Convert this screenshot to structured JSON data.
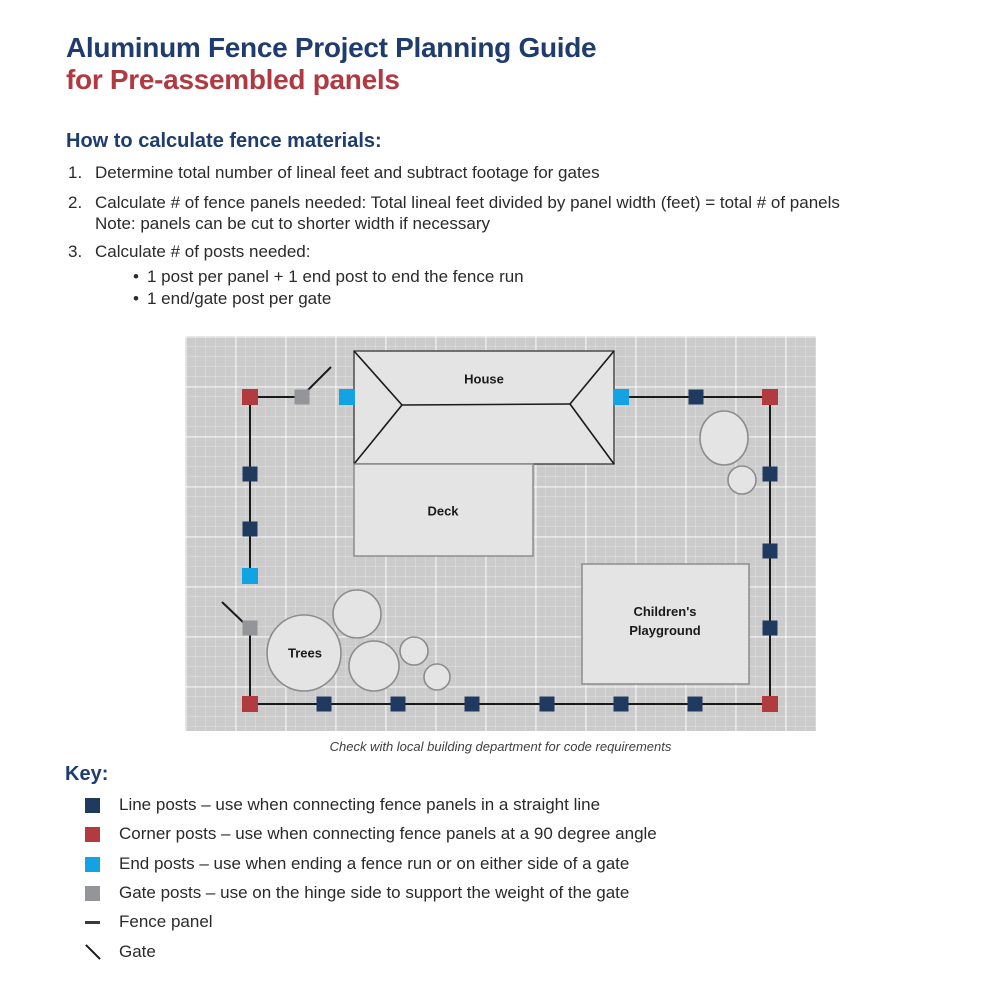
{
  "title": {
    "line1": "Aluminum Fence Project Planning Guide",
    "line2": "for Pre-assembled panels"
  },
  "colors": {
    "title_navy": "#1e3c6d",
    "title_red": "#b13a42",
    "text": "#2a2a2a",
    "line_post": "#20395f",
    "corner_post": "#b23b40",
    "end_post": "#14a3e2",
    "gate_post": "#939598",
    "fence_line": "#1a1a1a",
    "grid_bg": "#cbcbcb",
    "shape_fill": "#e4e4e4",
    "shape_stroke": "#8c8c8c",
    "house_stroke": "#4d4d4d"
  },
  "instructions": {
    "heading": "How to calculate fence materials:",
    "bullet_char": "•",
    "items": [
      {
        "num": "1.",
        "lines": [
          "Determine total number of lineal feet and subtract footage for gates"
        ]
      },
      {
        "num": "2.",
        "lines": [
          "Calculate # of fence panels needed: Total lineal feet divided by panel width (feet) = total # of panels",
          "Note: panels can be cut to shorter width if necessary"
        ]
      },
      {
        "num": "3.",
        "lines": [
          "Calculate # of posts needed:"
        ]
      }
    ],
    "bullets": [
      "1 post per panel + 1 end post to end the fence run",
      "1 end/gate post per gate"
    ]
  },
  "diagram": {
    "caption": "Check with local building department for code requirements",
    "labels": {
      "house": "House",
      "deck": "Deck",
      "trees": "Trees",
      "playground": "Children's\nPlayground"
    },
    "post_sizes": {
      "line": 15,
      "corner": 16,
      "end": 16,
      "gate": 15
    },
    "posts": [
      {
        "x": 65,
        "y": 61,
        "t": "corner"
      },
      {
        "x": 117,
        "y": 61,
        "t": "gate"
      },
      {
        "x": 162,
        "y": 61,
        "t": "end"
      },
      {
        "x": 436,
        "y": 61,
        "t": "end"
      },
      {
        "x": 511,
        "y": 61,
        "t": "line"
      },
      {
        "x": 585,
        "y": 61,
        "t": "corner"
      },
      {
        "x": 65,
        "y": 138,
        "t": "line"
      },
      {
        "x": 65,
        "y": 193,
        "t": "line"
      },
      {
        "x": 65,
        "y": 240,
        "t": "end"
      },
      {
        "x": 65,
        "y": 292,
        "t": "gate"
      },
      {
        "x": 585,
        "y": 138,
        "t": "line"
      },
      {
        "x": 585,
        "y": 215,
        "t": "line"
      },
      {
        "x": 585,
        "y": 292,
        "t": "line"
      },
      {
        "x": 65,
        "y": 368,
        "t": "corner"
      },
      {
        "x": 139,
        "y": 368,
        "t": "line"
      },
      {
        "x": 213,
        "y": 368,
        "t": "line"
      },
      {
        "x": 287,
        "y": 368,
        "t": "line"
      },
      {
        "x": 362,
        "y": 368,
        "t": "line"
      },
      {
        "x": 436,
        "y": 368,
        "t": "line"
      },
      {
        "x": 510,
        "y": 368,
        "t": "line"
      },
      {
        "x": 585,
        "y": 368,
        "t": "corner"
      }
    ],
    "fence_segments": [
      [
        65,
        61,
        117,
        61
      ],
      [
        436,
        61,
        585,
        61
      ],
      [
        585,
        61,
        585,
        368
      ],
      [
        65,
        368,
        585,
        368
      ],
      [
        65,
        61,
        65,
        243
      ],
      [
        65,
        292,
        65,
        368
      ]
    ],
    "gate_lines": [
      [
        123,
        54,
        146,
        31
      ],
      [
        37,
        266,
        60,
        288
      ]
    ],
    "house": {
      "x": 169,
      "y": 15,
      "w": 260,
      "h": 113,
      "roof_lines": [
        [
          169,
          15,
          217,
          69
        ],
        [
          169,
          128,
          217,
          69
        ],
        [
          217,
          69,
          385,
          68
        ],
        [
          429,
          15,
          385,
          68
        ],
        [
          429,
          128,
          385,
          68
        ]
      ]
    },
    "deck": {
      "x": 169,
      "y": 128,
      "w": 179,
      "h": 92
    },
    "playground": {
      "x": 397,
      "y": 228,
      "w": 167,
      "h": 120
    },
    "tree_circles": [
      [
        119,
        317,
        37,
        38
      ],
      [
        172,
        278,
        24,
        24
      ],
      [
        189,
        330,
        25,
        25
      ],
      [
        229,
        315,
        14,
        14
      ],
      [
        252,
        341,
        13,
        13
      ]
    ],
    "bush_circles": [
      [
        539,
        102,
        24,
        27
      ],
      [
        557,
        144,
        14,
        14
      ]
    ]
  },
  "key": {
    "heading": "Key:",
    "items": [
      {
        "symbol": "line_post",
        "label": "Line posts – use when connecting fence panels in a straight line"
      },
      {
        "symbol": "corner_post",
        "label": "Corner posts – use when connecting fence panels at a 90 degree angle"
      },
      {
        "symbol": "end_post",
        "label": "End posts – use when ending a fence run or on either side of a gate"
      },
      {
        "symbol": "gate_post",
        "label": "Gate posts – use on the hinge side to support the weight of the gate"
      },
      {
        "symbol": "fence_panel",
        "label": "Fence panel"
      },
      {
        "symbol": "gate",
        "label": "Gate"
      }
    ]
  }
}
